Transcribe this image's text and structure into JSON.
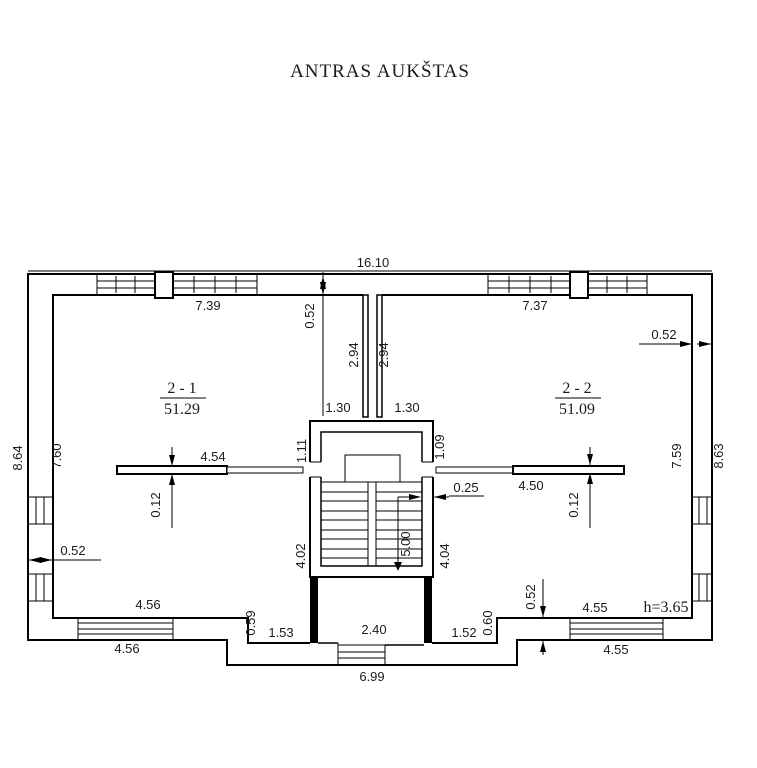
{
  "title": "ANTRAS AUKŠTAS",
  "rooms": {
    "r1": {
      "number": "2 - 1",
      "area": "51.29"
    },
    "r2": {
      "number": "2 - 2",
      "area": "51.09"
    }
  },
  "height_note": "h=3.65",
  "dims": {
    "total_width": "16.10",
    "room1_top": "7.39",
    "room2_top": "7.37",
    "wall_top": "0.52",
    "wall_right": "0.52",
    "wall_left": "0.52",
    "wall_bottom": "0.52",
    "shaft_left": "2.94",
    "shaft_right": "2.94",
    "opening_left": "1.30",
    "opening_right": "1.30",
    "stair_upper_left": "1.11",
    "stair_upper_right": "1.09",
    "stair_lower_left": "4.02",
    "stair_lower_right": "4.04",
    "stair_run": "5.00",
    "stair_wall": "0.25",
    "rail_left": "4.54",
    "rail_left_thk": "0.12",
    "rail_right": "4.50",
    "rail_right_thk": "0.12",
    "left_outer": "8.64",
    "left_inner": "7.60",
    "right_inner": "7.59",
    "right_outer": "8.63",
    "bottom_left_a": "4.56",
    "bottom_left_b": "4.56",
    "bottom_right_a": "4.55",
    "bottom_right_b": "4.55",
    "porch_step_left": "0.59",
    "porch_left": "1.53",
    "porch_width": "2.40",
    "porch_right": "1.52",
    "porch_step_right": "0.60",
    "porch_total": "6.99"
  }
}
